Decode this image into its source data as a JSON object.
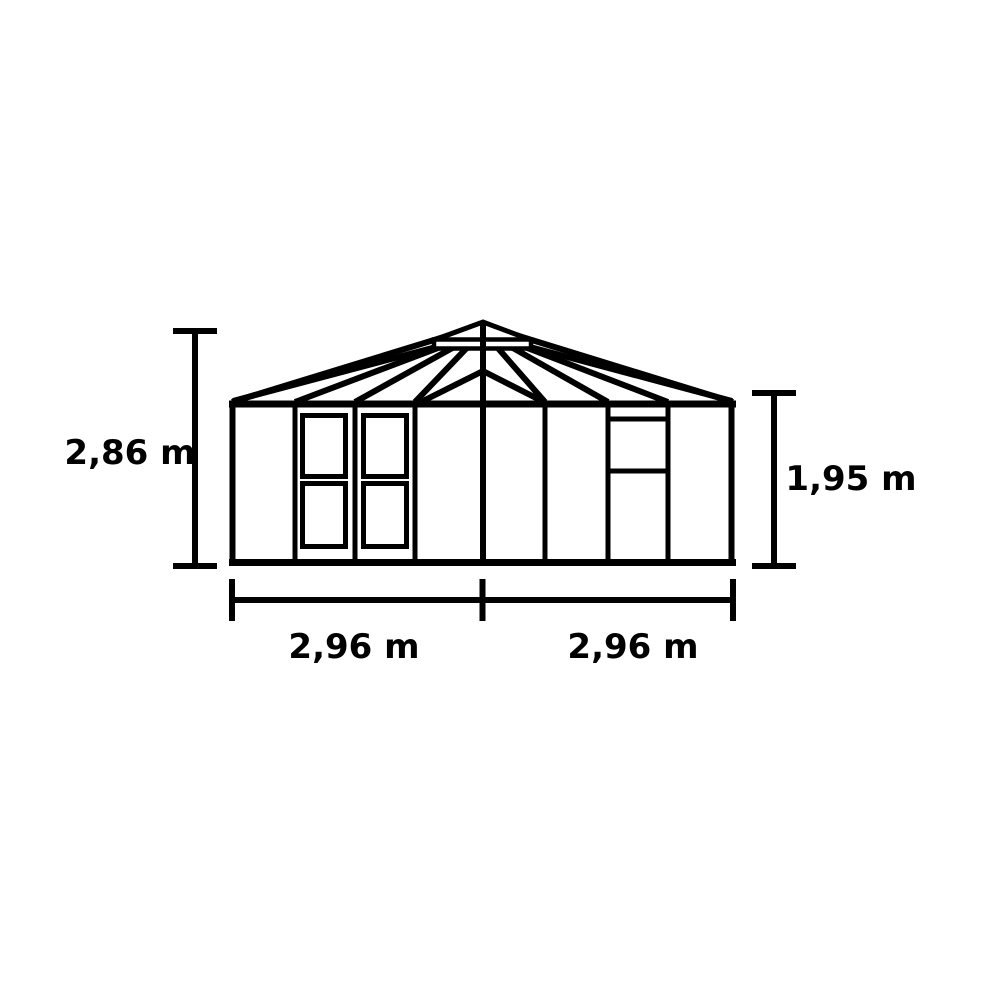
{
  "diagram": {
    "type": "greenhouse-front-elevation-drawing",
    "background_color": "#ffffff",
    "line_color": "#000000",
    "dimensions": {
      "overall_height": "2,86 m",
      "eave_height": "1,95 m",
      "width_left": "2,96 m",
      "width_right": "2,96 m"
    }
  }
}
